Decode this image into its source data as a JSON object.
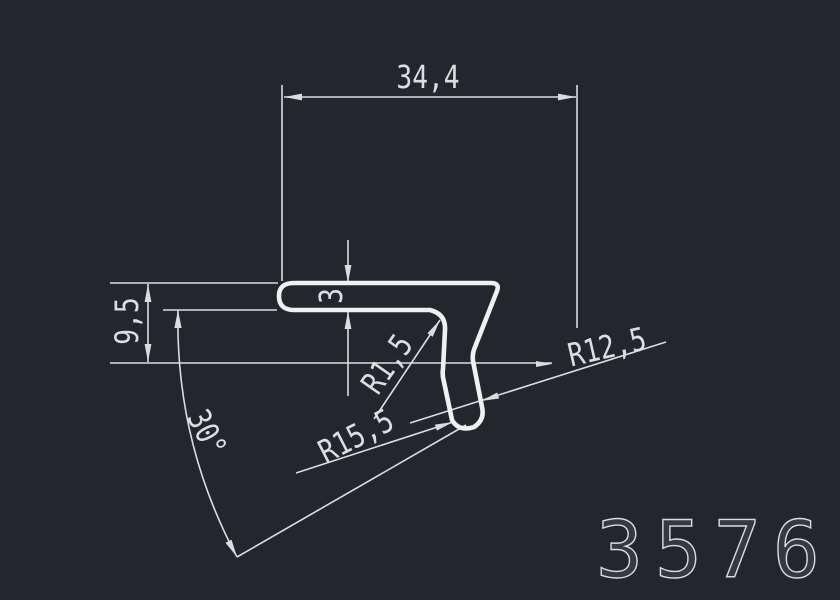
{
  "drawing": {
    "type": "profile-cross-section-drawing",
    "part_number": "3576",
    "dimensions": {
      "width": "34,4",
      "height": "9,5",
      "thickness": "3",
      "radius_inner": "R1,5",
      "radius_lower": "R15,5",
      "radius_outer": "R12,5",
      "angle": "30°"
    },
    "colors": {
      "background": "#23272c",
      "profile_line": "#eef0f2",
      "dimension_line": "#dadde0",
      "text": "#dcdfe2"
    }
  }
}
